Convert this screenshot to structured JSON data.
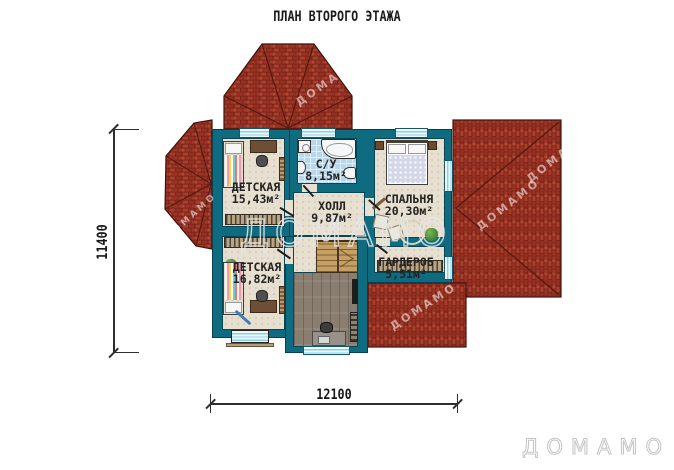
{
  "title": "ПЛАН ВТОРОГО ЭТАЖА",
  "rooms": [
    {
      "name": "ДЕТСКАЯ",
      "area": "15,43м²"
    },
    {
      "name": "С/У",
      "area": "8,15м²"
    },
    {
      "name": "ХОЛЛ",
      "area": "9,87м²"
    },
    {
      "name": "СПАЛЬНЯ",
      "area": "20,30м²"
    },
    {
      "name": "ДЕТСКАЯ",
      "area": "16,82м²"
    },
    {
      "name": "ГАРДЕРОБ",
      "area": "5,51м²"
    }
  ],
  "dimensions": {
    "vertical": "11400",
    "horizontal": "12100"
  },
  "watermark": {
    "text": "ДОМАМО"
  },
  "logo": {
    "text": "ДОМАМО"
  },
  "colors": {
    "wall_teal": "#0f6b80",
    "roof_red": "#a23d2c",
    "floor_beige": "#e7dfd0",
    "bath_tile": "#b8d7ea",
    "wood_floor": "#8a7e70",
    "stairs": "#c59f63"
  }
}
